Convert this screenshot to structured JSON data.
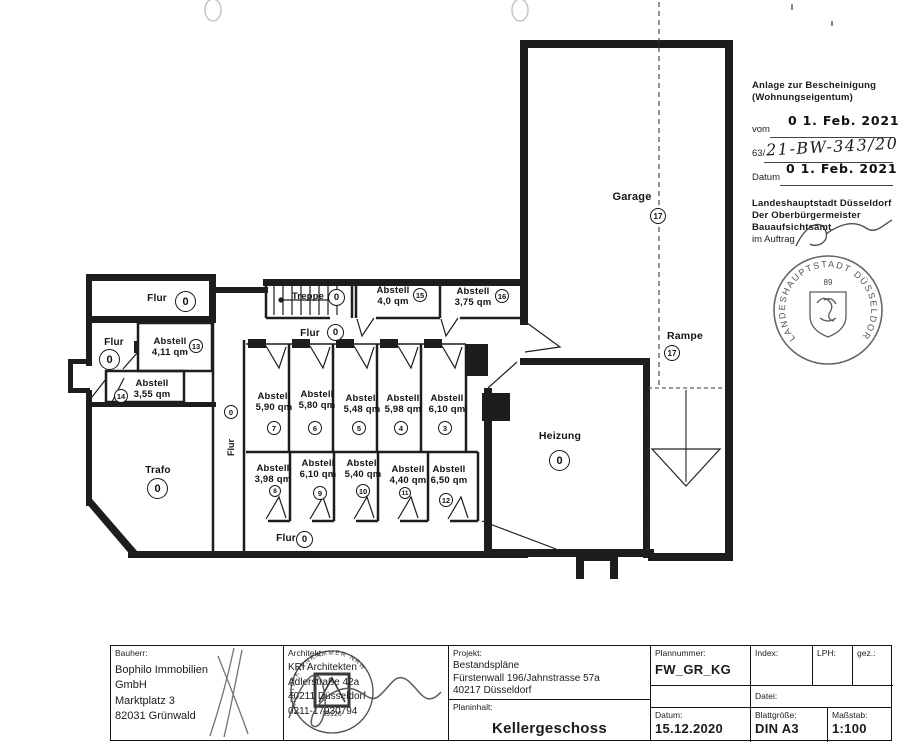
{
  "annotations": {
    "title_line1": "Anlage zur Bescheinigung",
    "title_line2": "(Wohnungseigentum)",
    "vom_label": "vom",
    "vom_date": "0 1. Feb. 2021",
    "file_prefix": "63/",
    "file_number": "21-BW-343/20",
    "datum_label": "Datum",
    "datum_date": "0 1. Feb. 2021",
    "authority_line1": "Landeshauptstadt Düsseldorf",
    "authority_line2": "Der Oberbürgermeister",
    "authority_line3": "Bauaufsichtsamt",
    "im_auftrag": "im Auftrag",
    "round_stamp": {
      "ring_text": "LANDESHAUPTSTADT DÜSSELDORF",
      "number": "89"
    }
  },
  "plan": {
    "rooms": [
      {
        "id": "flur-top-left",
        "label": "Flur",
        "area": "",
        "num": "0"
      },
      {
        "id": "flur-left",
        "label": "Flur",
        "area": "",
        "num": "0"
      },
      {
        "id": "abstell-13",
        "label": "Abstell",
        "area": "4,11 qm",
        "num": "13"
      },
      {
        "id": "abstell-14",
        "label": "Abstell",
        "area": "3,55 qm",
        "num": "14"
      },
      {
        "id": "trafo",
        "label": "Trafo",
        "area": "",
        "num": "0"
      },
      {
        "id": "flur-vertical",
        "label": "Flur",
        "area": "",
        "num": "0"
      },
      {
        "id": "treppe",
        "label": "Treppe",
        "area": "",
        "num": "0"
      },
      {
        "id": "flur-mid",
        "label": "Flur",
        "area": "",
        "num": "0"
      },
      {
        "id": "abstell-15",
        "label": "Abstell",
        "area": "4,0 qm",
        "num": "15"
      },
      {
        "id": "abstell-16",
        "label": "Abstell",
        "area": "3,75 qm",
        "num": "16"
      },
      {
        "id": "abstell-7",
        "label": "Abstell",
        "area": "5,90 qm",
        "num": "7"
      },
      {
        "id": "abstell-6",
        "label": "Abstell",
        "area": "5,80 qm",
        "num": "6"
      },
      {
        "id": "abstell-5",
        "label": "Abstell",
        "area": "5,48 qm",
        "num": "5"
      },
      {
        "id": "abstell-4",
        "label": "Abstell",
        "area": "5,98 qm",
        "num": "4"
      },
      {
        "id": "abstell-3",
        "label": "Abstell",
        "area": "6,10 qm",
        "num": "3"
      },
      {
        "id": "abstell-8",
        "label": "Abstell",
        "area": "3,98 qm",
        "num": "8"
      },
      {
        "id": "abstell-9",
        "label": "Abstell",
        "area": "6,10 qm",
        "num": "9"
      },
      {
        "id": "abstell-10",
        "label": "Abstell",
        "area": "5,40 qm",
        "num": "10"
      },
      {
        "id": "abstell-11",
        "label": "Abstell",
        "area": "4,40 qm",
        "num": "11"
      },
      {
        "id": "abstell-12",
        "label": "Abstell",
        "area": "6,50 qm",
        "num": "12"
      },
      {
        "id": "flur-bottom",
        "label": "Flur",
        "area": "",
        "num": "0"
      },
      {
        "id": "heizung",
        "label": "Heizung",
        "area": "",
        "num": "0"
      },
      {
        "id": "garage",
        "label": "Garage",
        "area": "",
        "num": "17"
      },
      {
        "id": "rampe",
        "label": "Rampe",
        "area": "",
        "num": "17"
      }
    ]
  },
  "titleblock": {
    "bauherr": {
      "label": "Bauherr:",
      "lines": [
        "Bophilo Immobilien",
        "GmbH",
        "Marktplatz 3",
        "82031 Grünwald"
      ]
    },
    "architekt": {
      "label": "Architekt:",
      "lines": [
        "KRI Architekten",
        "Adlerstraße 42a",
        "40211 Düsseldorf",
        "0211-17930794"
      ],
      "stamp_ring": "ARCHITEKTENKAMMER NRW",
      "stamp_number": "39126"
    },
    "projekt": {
      "label": "Projekt:",
      "lines": [
        "Bestandspläne",
        "Fürstenwall 196/Jahnstrasse 57a",
        "40217 Düsseldorf"
      ]
    },
    "planinhalt": {
      "label": "Planinhalt:",
      "value": "Kellergeschoss"
    },
    "plannummer": {
      "label": "Plannummer:",
      "value": "FW_GR_KG"
    },
    "index": {
      "label": "Index:",
      "value": ""
    },
    "lph": {
      "label": "LPH:",
      "value": ""
    },
    "gez": {
      "label": "gez.:",
      "value": ""
    },
    "datei": {
      "label": "Datei:",
      "value": ""
    },
    "datum": {
      "label": "Datum:",
      "value": "15.12.2020"
    },
    "blattgroesse": {
      "label": "Blattgröße:",
      "value": "DIN A3"
    },
    "massstab": {
      "label": "Maßstab:",
      "value": "1:100"
    }
  }
}
